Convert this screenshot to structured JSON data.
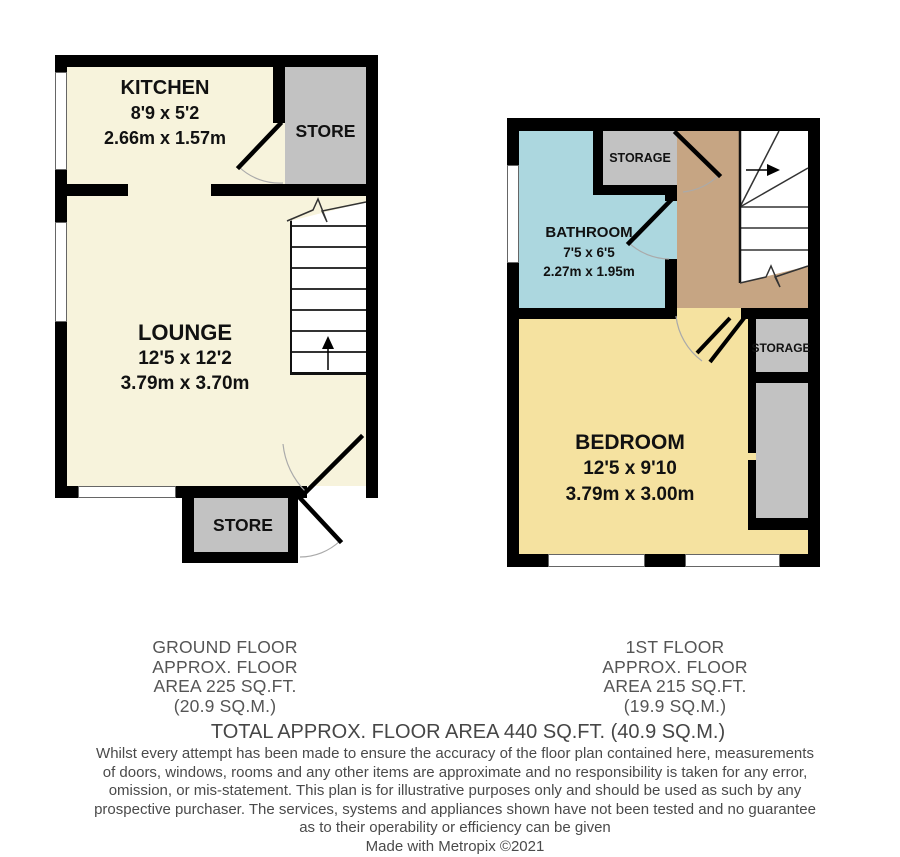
{
  "ground_floor": {
    "kitchen": {
      "name": "KITCHEN",
      "dims_ft": "8'9 x 5'2",
      "dims_m": "2.66m x 1.57m"
    },
    "store_top": {
      "name": "STORE"
    },
    "lounge": {
      "name": "LOUNGE",
      "dims_ft": "12'5 x 12'2",
      "dims_m": "3.79m x 3.70m"
    },
    "store_bottom": {
      "name": "STORE"
    },
    "summary": {
      "line1": "GROUND FLOOR",
      "line2": "APPROX. FLOOR",
      "line3": "AREA 225 SQ.FT.",
      "line4": "(20.9 SQ.M.)"
    }
  },
  "first_floor": {
    "storage_top": {
      "name": "STORAGE"
    },
    "bathroom": {
      "name": "BATHROOM",
      "dims_ft": "7'5 x 6'5",
      "dims_m": "2.27m x 1.95m"
    },
    "bedroom": {
      "name": "BEDROOM",
      "dims_ft": "12'5 x 9'10",
      "dims_m": "3.79m x 3.00m"
    },
    "storage_right": {
      "name": "STORAGE"
    },
    "summary": {
      "line1": "1ST FLOOR",
      "line2": "APPROX. FLOOR",
      "line3": "AREA 215 SQ.FT.",
      "line4": "(19.9 SQ.M.)"
    }
  },
  "total_line": "TOTAL APPROX. FLOOR AREA 440 SQ.FT. (40.9 SQ.M.)",
  "disclaimer": {
    "lines": [
      "Whilst every attempt has been made to ensure the accuracy of the floor plan contained here, measurements",
      "of doors, windows, rooms and any other items are approximate and no responsibility is taken for any error,",
      "omission, or mis-statement. This plan is for illustrative purposes only and should be used as such by any",
      "prospective purchaser. The services, systems and appliances shown have not been tested and no guarantee",
      "as to their operability or efficiency can be given"
    ]
  },
  "credit": "Made with Metropix ©2021",
  "colors": {
    "room_cream": "#F7F3DC",
    "bedroom_yellow": "#F5E2A0",
    "bathroom_blue": "#ACD7DF",
    "landing_tan": "#C6A583",
    "storage_gray": "#C2C2C2",
    "wall_black": "#000000",
    "text_gray": "#4A4A4A"
  }
}
